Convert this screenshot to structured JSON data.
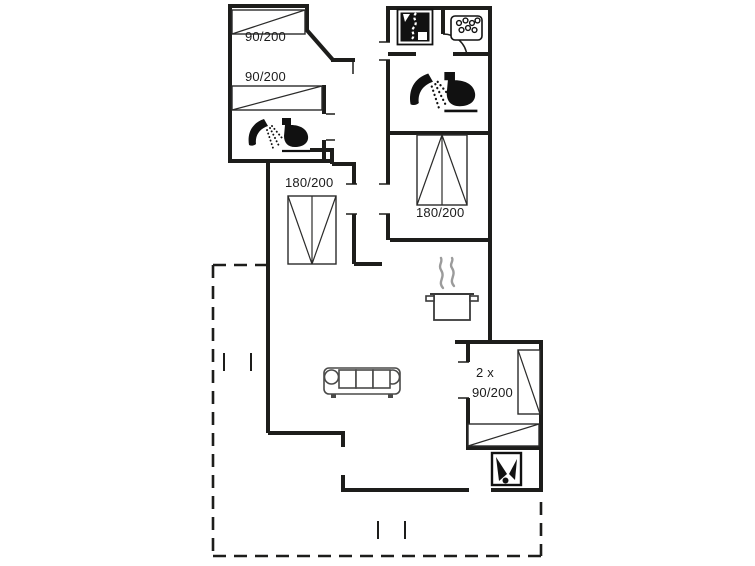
{
  "colors": {
    "wall": "#1d1d1b",
    "bed": "#2b2b2a",
    "furniture": "#4a4a49",
    "steam": "#9b9b9b",
    "icon": "#111111",
    "background": "#ffffff"
  },
  "bed_labels": {
    "top_single_1": "90/200",
    "top_single_2": "90/200",
    "left_double": "180/200",
    "right_double": "180/200",
    "bottom_line_1": "2 x",
    "bottom_line_2": "90/200"
  },
  "icons": {
    "shower": "shower-icon",
    "toilet": "toilet-icon",
    "whirlpool": "whirlpool-icon",
    "washing_machine": "washing-machine-icon",
    "wood_stove": "wood-stove-icon",
    "cooking_pot": "cooking-pot-steam-icon",
    "sofa": "sofa-icon",
    "single_bed": "single-bed-icon",
    "double_bed": "double-bed-icon",
    "door_arc": "door-swing-arc",
    "terrace": "terrace-dashed-outline"
  }
}
